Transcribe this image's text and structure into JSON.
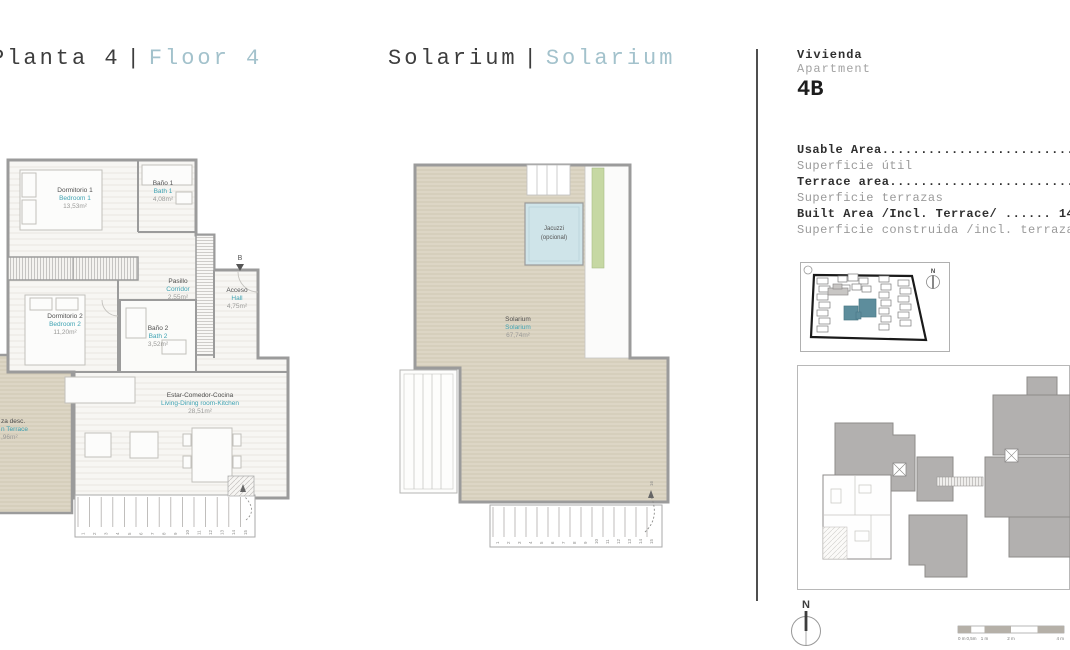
{
  "colors": {
    "accent_teal": "#a3c2cc",
    "room_teal": "#3fa3b3",
    "deck_tan": "#ddd6c5",
    "planter_green": "#c6d8a3",
    "jacuzzi_blue": "#cfe4e9",
    "keyplan_gray": "#b2b0af",
    "siteplan_teal": "#5d8d9c"
  },
  "title_floor": {
    "es": "Planta 4",
    "sep": "|",
    "en": "Floor 4"
  },
  "title_solarium": {
    "es": "Solarium",
    "sep": "|",
    "en": "Solarium"
  },
  "unit": {
    "label_es": "Vivienda",
    "label_en": "Apartment",
    "code": "4B"
  },
  "areas": [
    {
      "en": "Usable Area..............................",
      "es": "Superficie útil"
    },
    {
      "en": "Terrace area.............................",
      "es": "Superficie terrazas"
    },
    {
      "en": "Built Area /Incl. Terrace/ ...... 14",
      "es": "Superficie construida /incl. terrazas"
    }
  ],
  "plan_floor": {
    "rooms": [
      {
        "es": "Dormitorio 1",
        "en": "Bedroom 1",
        "area": "13,53m²"
      },
      {
        "es": "Baño 1",
        "en": "Bath 1",
        "area": "4,08m²"
      },
      {
        "es": "Pasillo",
        "en": "Corridor",
        "area": "2,55m²"
      },
      {
        "es": "Acceso",
        "en": "Hall",
        "area": "4,75m²"
      },
      {
        "es": "Dormitorio 2",
        "en": "Bedroom 2",
        "area": "11,20m²"
      },
      {
        "es": "Baño 2",
        "en": "Bath 2",
        "area": "3,52m²"
      },
      {
        "es": "Estar-Comedor-Cocina",
        "en": "Living-Dining room-Kitchen",
        "area": "28,51m²"
      },
      {
        "es": "za desc.",
        "en": "n Terrace",
        "area": ",96m²"
      }
    ],
    "marker_b": "B",
    "stair_numbers": [
      "1",
      "2",
      "3",
      "4",
      "5",
      "6",
      "7",
      "8",
      "9",
      "10",
      "11",
      "12",
      "13",
      "14",
      "15"
    ]
  },
  "plan_solarium": {
    "room": {
      "es": "Solarium",
      "en": "Solarium",
      "area": "67,74m²"
    },
    "jacuzzi": {
      "line1": "Jacuzzi",
      "line2": "(opcional)"
    },
    "stair_numbers": [
      "1",
      "2",
      "3",
      "4",
      "5",
      "6",
      "7",
      "8",
      "9",
      "10",
      "11",
      "12",
      "13",
      "14",
      "15"
    ],
    "last_step": "16"
  },
  "site_plan": {
    "north": "N"
  },
  "compass": {
    "north": "N"
  },
  "scale_bar": {
    "labels": [
      "0 m",
      "0,5m",
      "1 m",
      "2 m",
      "4 m"
    ]
  }
}
